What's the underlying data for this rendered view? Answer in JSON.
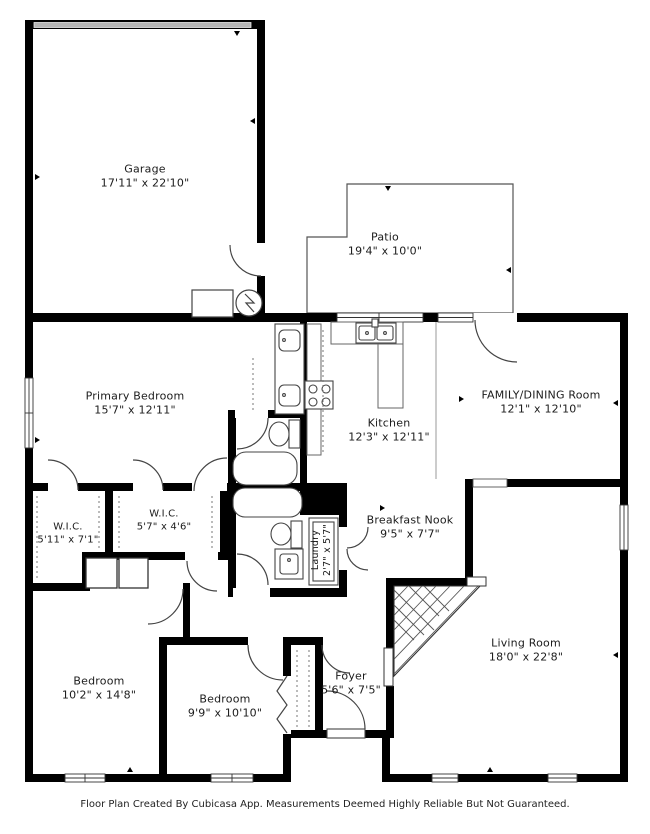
{
  "floor_plan": {
    "rooms": [
      {
        "name": "Garage",
        "dims": "17'11\" x 22'10\""
      },
      {
        "name": "Patio",
        "dims": "19'4\" x 10'0\""
      },
      {
        "name": "Primary Bedroom",
        "dims": "15'7\" x 12'11\""
      },
      {
        "name": "Kitchen",
        "dims": "12'3\" x 12'11\""
      },
      {
        "name": "FAMILY/DINING Room",
        "dims": "12'1\" x 12'10\""
      },
      {
        "name": "W.I.C.",
        "dims": "5'11\" x 7'1\""
      },
      {
        "name": "W.I.C.",
        "dims": "5'7\" x 4'6\""
      },
      {
        "name": "Breakfast Nook",
        "dims": "9'5\" x 7'7\""
      },
      {
        "name": "Laundry",
        "dims": "2'7\" x 5'7\""
      },
      {
        "name": "Living Room",
        "dims": "18'0\" x 22'8\""
      },
      {
        "name": "Bedroom",
        "dims": "10'2\" x 14'8\""
      },
      {
        "name": "Bedroom",
        "dims": "9'9\" x 10'10\""
      },
      {
        "name": "Foyer",
        "dims": "5'6\" x 7'5\""
      }
    ],
    "footer": "Floor Plan Created By Cubicasa App. Measurements Deemed Highly Reliable But Not Guaranteed.",
    "colors": {
      "wall": "#000000",
      "garage_door": "#b5b5b5",
      "background": "#ffffff"
    }
  }
}
